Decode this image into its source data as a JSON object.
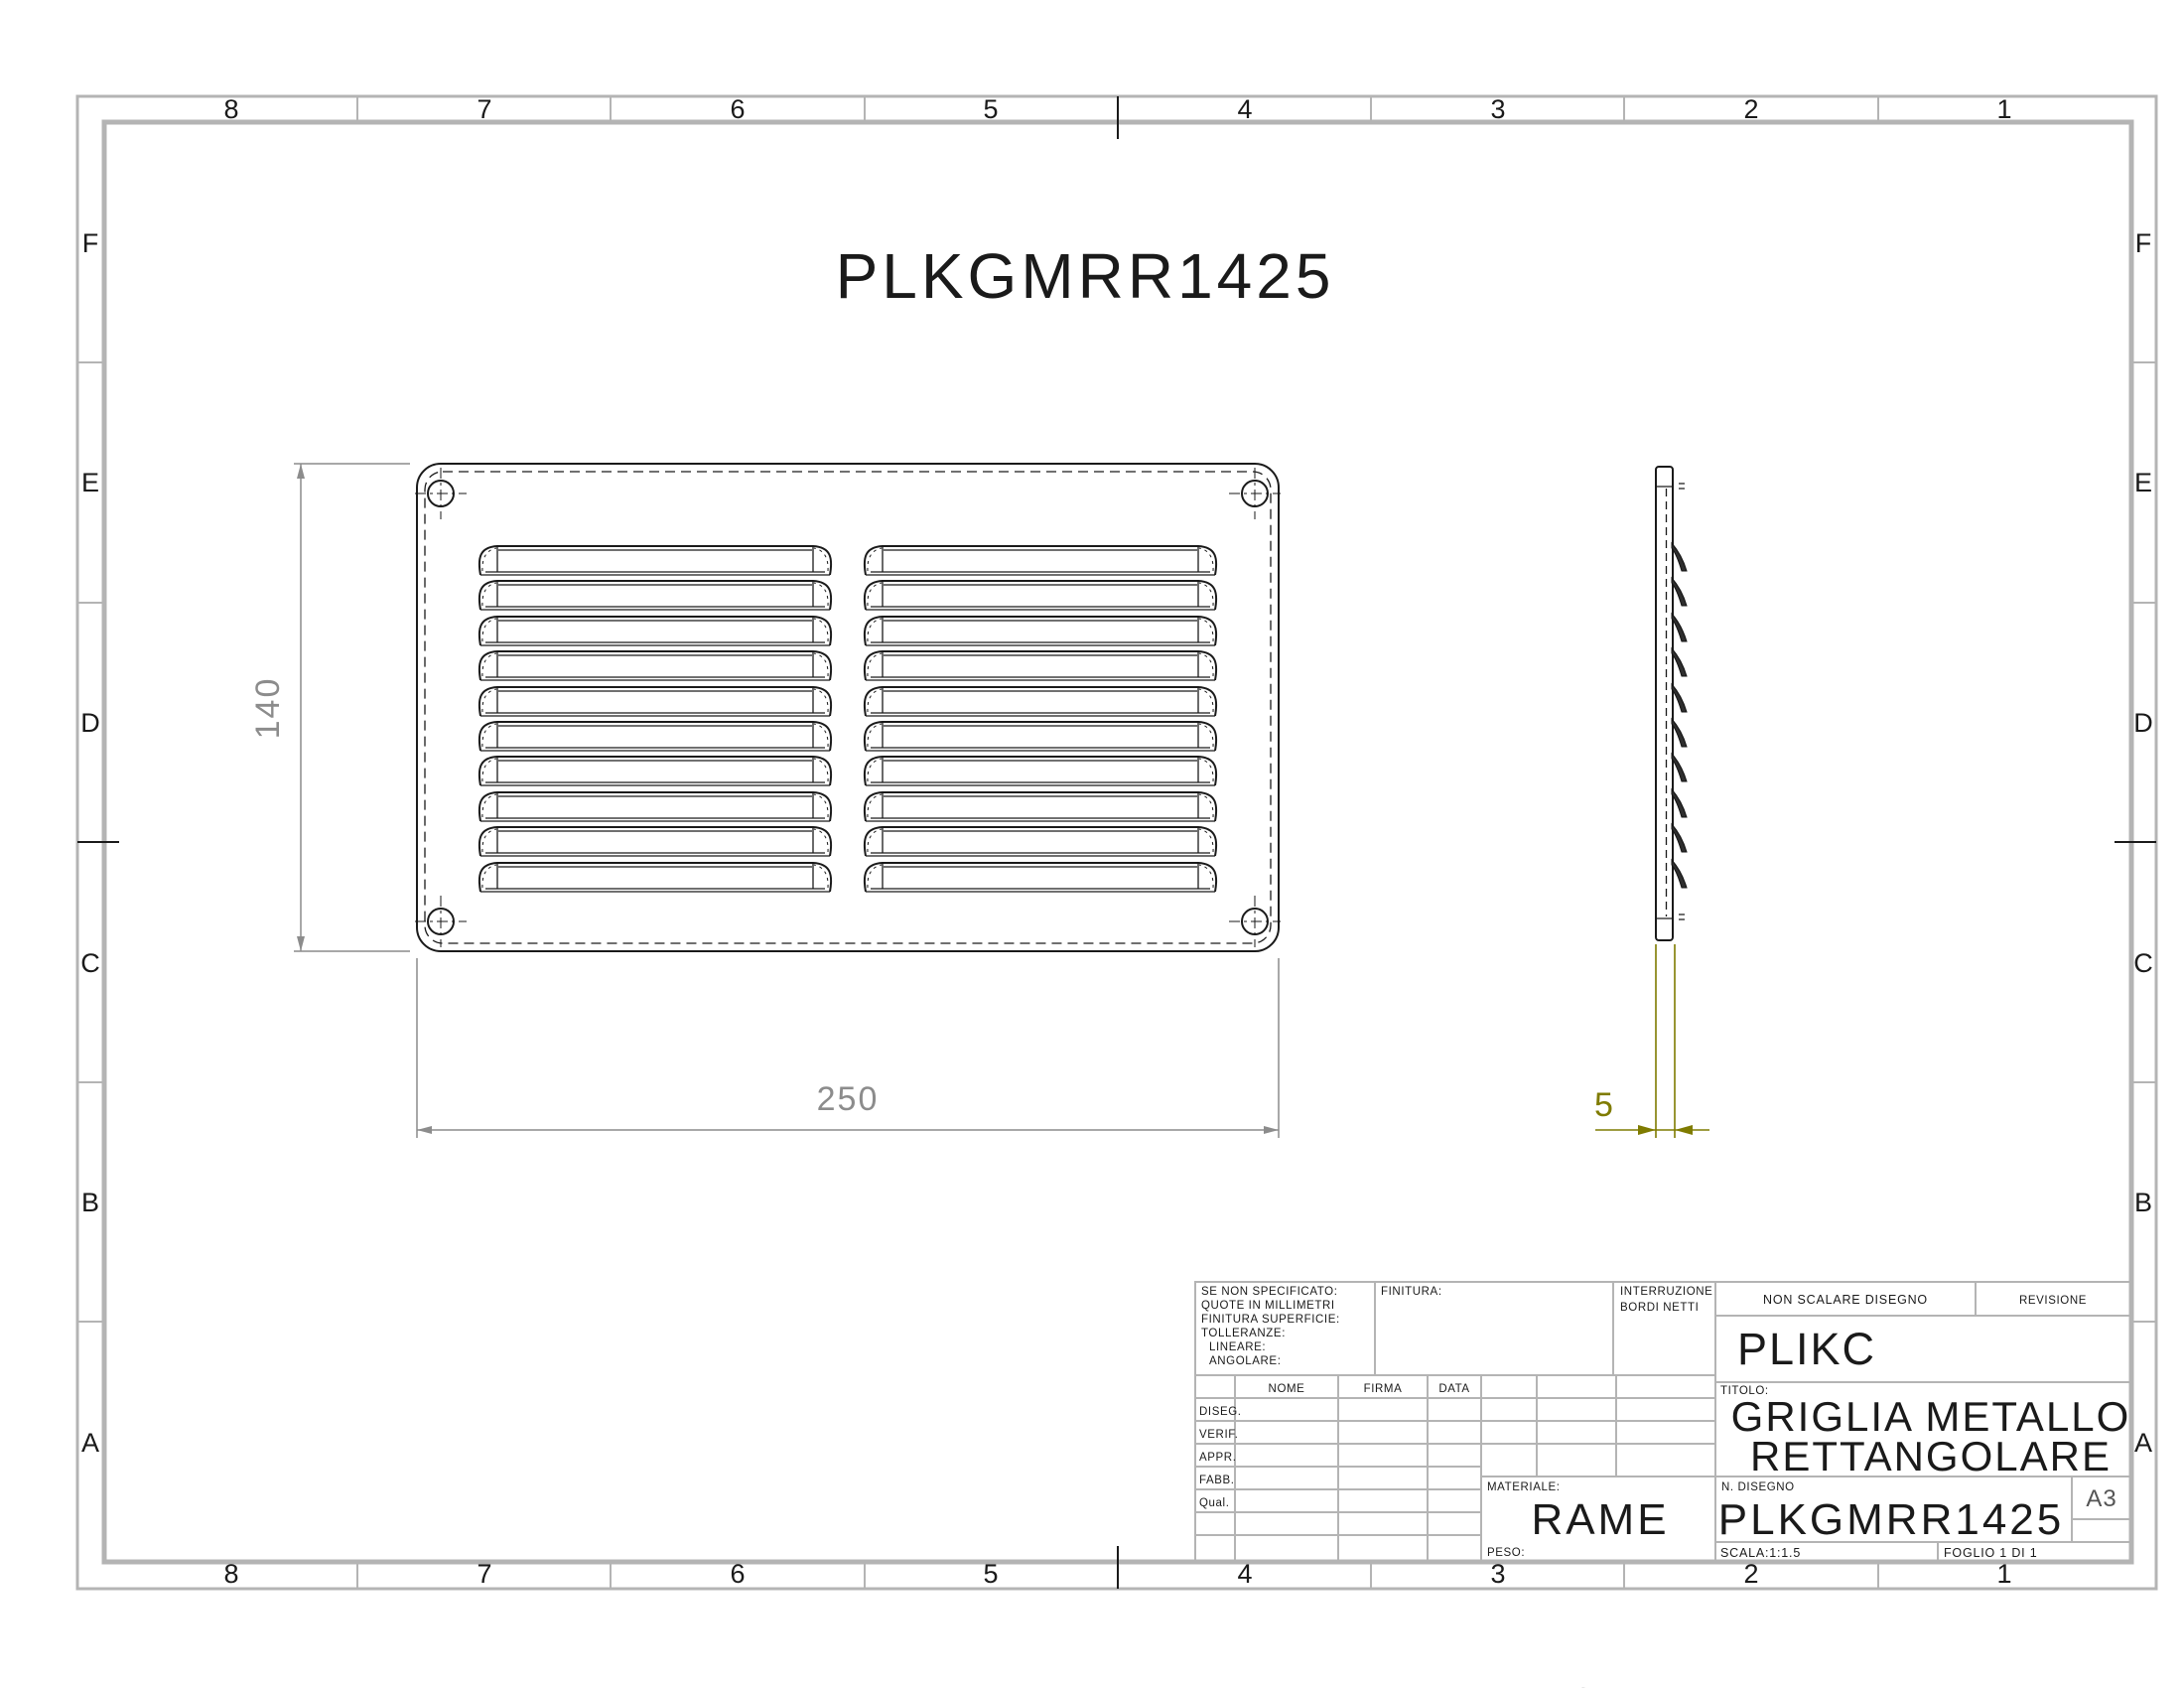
{
  "sheet": {
    "drawing_title": "PLKGMRR1425",
    "grid_cols": [
      "8",
      "7",
      "6",
      "5",
      "4",
      "3",
      "2",
      "1"
    ],
    "grid_rows": [
      "F",
      "E",
      "D",
      "C",
      "B",
      "A"
    ],
    "bottom_cropped_text": "ALLUMINIO"
  },
  "dimensions": {
    "front_height": "140",
    "front_width": "250",
    "side_thickness": "5"
  },
  "title_block": {
    "tolerance_note": [
      "SE NON SPECIFICATO:",
      "QUOTE IN MILLIMETRI",
      "FINITURA SUPERFICIE:",
      "TOLLERANZE:",
      "LINEARE:",
      "ANGOLARE:"
    ],
    "finish_label": "FINITURA:",
    "edges_note_line1": "INTERRUZIONE",
    "edges_note_line2": "BORDI NETTI",
    "do_not_scale": "NON SCALARE DISEGNO",
    "revision_label": "REVISIONE",
    "company": "PLIKC",
    "title_label": "TITOLO:",
    "title_line1": "GRIGLIA METALLO",
    "title_line2": "RETTANGOLARE",
    "sign_table": {
      "headers": [
        "NOME",
        "FIRMA",
        "DATA"
      ],
      "rows": [
        "DISEG.",
        "VERIF.",
        "APPR.",
        "FABB.",
        "Qual."
      ]
    },
    "material_label": "MATERIALE:",
    "material_value": "RAME",
    "weight_label": "PESO:",
    "drawing_no_label": "N. DISEGNO",
    "drawing_no": "PLKGMRR1425",
    "paper_size": "A3",
    "scale_label": "SCALA:1:1.5",
    "sheet_no_label": "FOGLIO 1 DI 1"
  },
  "colors": {
    "background": "#ffffff",
    "frame_gray": "#b4b4b4",
    "line_black": "#1a1a1a",
    "dimension_gray": "#8c8c8c",
    "dimension_olive": "#7f7b00"
  }
}
